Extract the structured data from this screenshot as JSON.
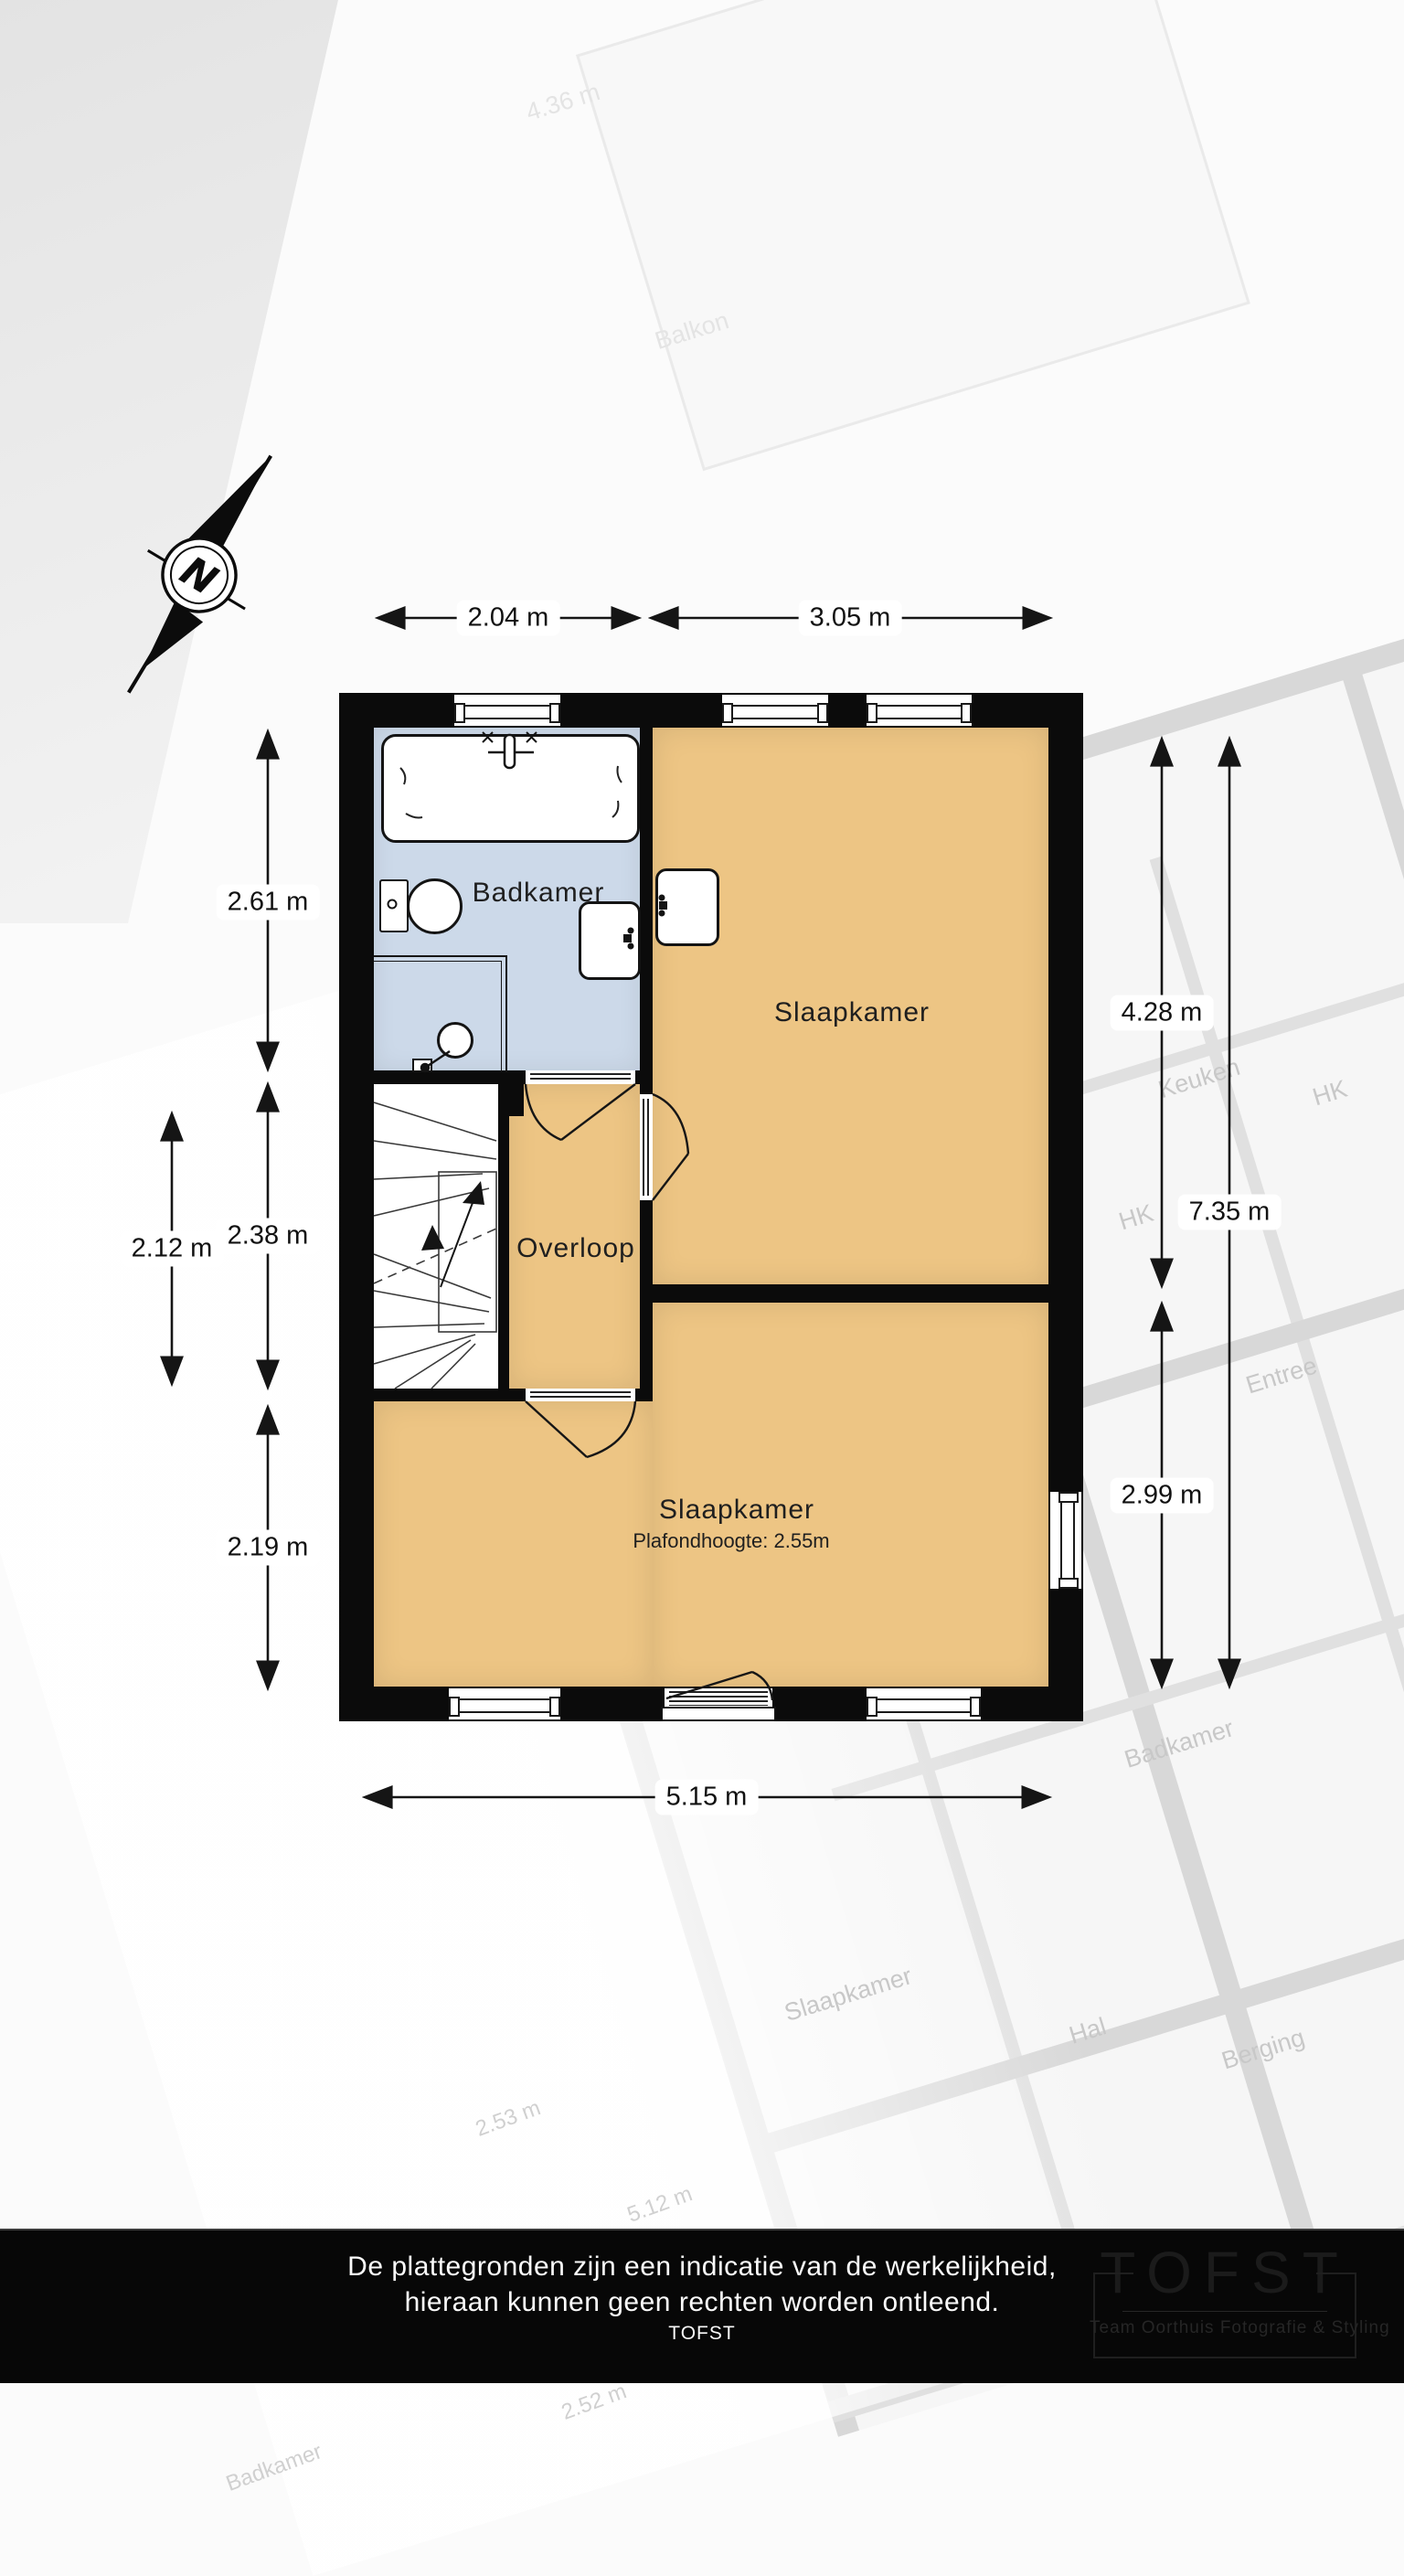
{
  "compass": {
    "letter": "N"
  },
  "dimensions": {
    "top": [
      {
        "label": "2.04 m"
      },
      {
        "label": "3.05 m"
      }
    ],
    "left_inner": [
      {
        "label": "2.61 m"
      },
      {
        "label": "2.38 m"
      },
      {
        "label": "2.19 m"
      }
    ],
    "left_outer": {
      "label": "2.12 m"
    },
    "right_inner": [
      {
        "label": "4.28 m"
      },
      {
        "label": "2.99 m"
      }
    ],
    "right_outer": {
      "label": "7.35 m"
    },
    "bottom": {
      "label": "5.15 m"
    }
  },
  "rooms": {
    "badkamer": {
      "label": "Badkamer"
    },
    "slaapkamer_top": {
      "label": "Slaapkamer"
    },
    "overloop": {
      "label": "Overloop"
    },
    "slaapkamer_bottom": {
      "label": "Slaapkamer",
      "note": "Plafondhoogte: 2.55m"
    }
  },
  "background_plan": {
    "labels": [
      {
        "text": "Keuken"
      },
      {
        "text": "HK"
      },
      {
        "text": "HK"
      },
      {
        "text": "Entree"
      },
      {
        "text": "Badkamer"
      },
      {
        "text": "Slaapkamer"
      },
      {
        "text": "Hal"
      },
      {
        "text": "Berging"
      },
      {
        "text": "Kast"
      },
      {
        "text": "2.53 m"
      },
      {
        "text": "5.12 m"
      },
      {
        "text": "2.52 m"
      },
      {
        "text": "Badkamer"
      },
      {
        "text": "4.36 m"
      },
      {
        "text": "Balkon"
      }
    ]
  },
  "footer": {
    "disclaimer_line1": "De plattegronden zijn een indicatie van de werkelijkheid,",
    "disclaimer_line2": "hieraan kunnen geen rechten worden ontleend.",
    "attribution": "TOFST",
    "logo": {
      "title": "TOFST",
      "subtitle": "Team Oorthuis Fotografie & Styling"
    }
  },
  "colors": {
    "room_fill": "#edc584",
    "bathroom_fill": "#ccd9e9",
    "wall": "#0b0b0b",
    "footer_bg": "#070707"
  }
}
